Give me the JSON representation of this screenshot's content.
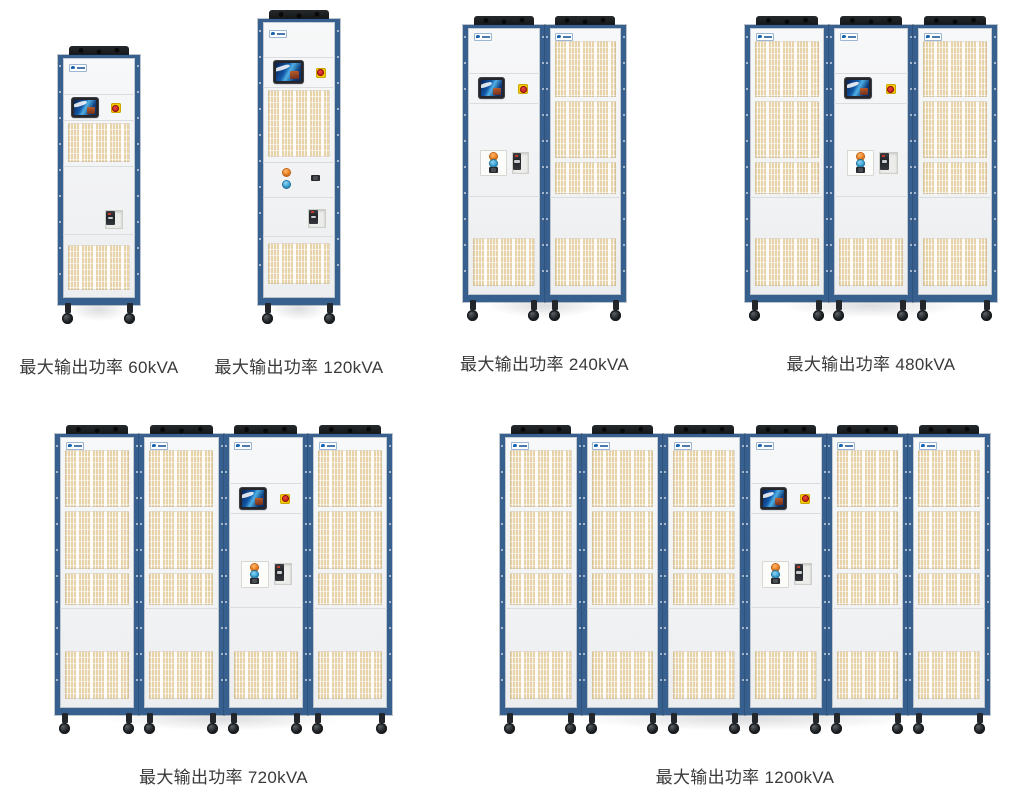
{
  "page": {
    "background": "#ffffff",
    "language": "zh-CN",
    "content": "模块化功率柜产品系列"
  },
  "groups": [
    {
      "name": "60kVA",
      "caption": "最大输出功率 60kVA",
      "max_output_power": "60kVA",
      "cabinet_count": 1,
      "cabinets": [
        "control-s"
      ]
    },
    {
      "name": "120kVA",
      "caption": "最大输出功率 120kVA",
      "max_output_power": "120kVA",
      "cabinet_count": 1,
      "cabinets": [
        "control-m"
      ]
    },
    {
      "name": "240kVA",
      "caption": "最大输出功率 240kVA",
      "max_output_power": "240kVA",
      "cabinet_count": 2,
      "cabinets": [
        "control",
        "vent"
      ]
    },
    {
      "name": "480kVA",
      "caption": "最大输出功率 480kVA",
      "max_output_power": "480kVA",
      "cabinet_count": 3,
      "cabinets": [
        "vent",
        "control",
        "vent"
      ]
    },
    {
      "name": "720kVA",
      "caption": "最大输出功率 720kVA",
      "max_output_power": "720kVA",
      "cabinet_count": 4,
      "cabinets": [
        "vent",
        "vent",
        "control",
        "vent"
      ]
    },
    {
      "name": "1200kVA",
      "caption": "最大输出功率 1200kVA",
      "max_output_power": "1200kVA",
      "cabinet_count": 6,
      "cabinets": [
        "vent",
        "vent",
        "vent",
        "control",
        "vent",
        "vent"
      ]
    }
  ],
  "colors": {
    "frame_blue": "#37608f",
    "frame_blue_dark": "#22466e",
    "panel_white": "#f3f4f5",
    "vent_beige": "#e8d3a9",
    "caption_text": "#3a3a3a",
    "estop_yellow": "#f3cd06",
    "estop_red": "#c42020",
    "button_orange": "#ef7c1a",
    "button_blue": "#2d9fd6",
    "screen_blue": "#1563b0",
    "fan_black": "#26292c"
  },
  "icons": {
    "brand_logo": "brand-logo-badge",
    "touchscreen": "touchscreen-display",
    "emergency_stop": "emergency-stop-button",
    "circuit_breaker": "circuit-breaker",
    "ventilation": "ventilation-grille",
    "cooling_fan": "cooling-fan",
    "caster": "caster-wheel"
  }
}
